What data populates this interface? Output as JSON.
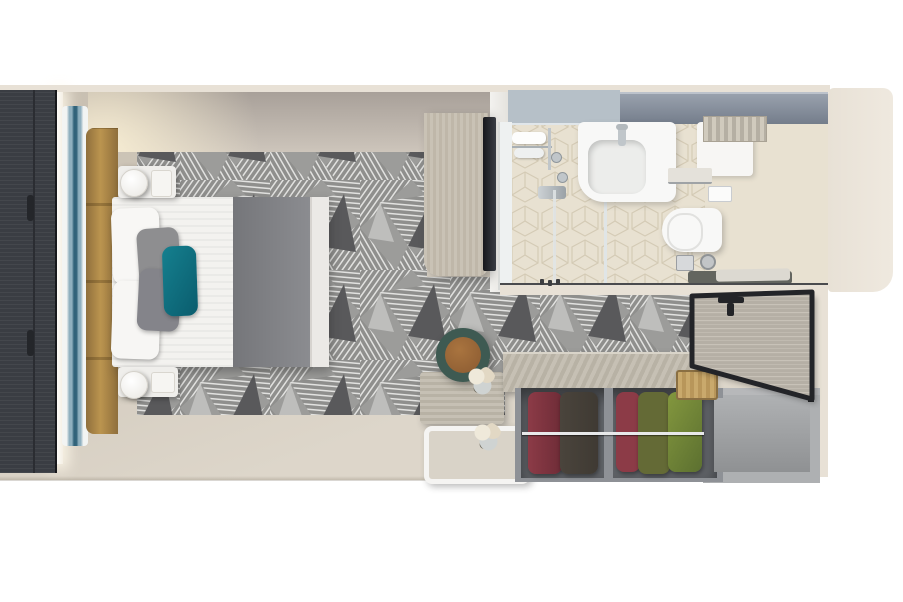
{
  "meta": {
    "title": "Top-down 3D rendered floor plan of a cruise-ship balcony stateroom",
    "canvas": {
      "width": 903,
      "height": 602
    }
  },
  "colors": {
    "wall-cream": "#e8e1d6",
    "floor-light": "#ddd6ca",
    "floor-dark": "#c7beb0",
    "panel-dark": "#3a3d43",
    "art-white": "#f2f4f3",
    "art-blue-mid": "#8fb0bf",
    "art-blue-deep": "#31637a",
    "headboard-tan-1": "#8f6f3c",
    "headboard-tan-2": "#bb944f",
    "wall-strip-1": "#a8a099",
    "wall-strip-2": "#cdc5bb",
    "carpet-base": "#9c9c9a",
    "carpet-mid": "#8f8f8d",
    "carpet-line": "#e2e2e0",
    "carpet-dark": "#59595b",
    "carpet-light": "#c4c4c2",
    "bed-white": "#f3f2ef",
    "runner-1": "#75767a",
    "runner-2": "#8b8c90",
    "pillow-gray": "#8e8e90",
    "pillow-teal-1": "#15808f",
    "pillow-teal-2": "#0a5c6d",
    "wood-light-1": "#c9c2b5",
    "wood-light-2": "#bfb7a9",
    "mirror-dark": "#17181c",
    "bath-floor": "#e8e1d1",
    "tile-line": "#d2c8b2",
    "cabinet-blue": "#b6c0c8",
    "mirror-blue-1": "#99a1ad",
    "mirror-blue-2": "#747d8b",
    "porcelain": "#f8f8f7",
    "chrome": "#c0c6ca",
    "glass-line": "#e0e5e6",
    "mat-dark": "#63655f",
    "mat-towel": "#dcd9d1",
    "stool-rim": "#3e5a52",
    "stool-leather": "#a9743f",
    "counter-wood-1": "#c6c0b4",
    "counter-wood-2": "#b8b2a5",
    "wardrobe-interior": "#5f6267",
    "wardrobe-frame": "#8e9196",
    "cloth-maroon": "#8c3b47",
    "cloth-dark": "#3f3a33",
    "cloth-olive": "#646a36",
    "cloth-green": "#83973e",
    "door-wood-1": "#b5afa5",
    "door-wood-2": "#c8c2b8",
    "frame-dark": "#232428",
    "nook-1": "#aeb0b2",
    "nook-2": "#8f9193"
  },
  "objects": {
    "bed": "double bed, white linens, grey foot runner, grey and teal pillows",
    "nightstands": "two white marble nightstands with cylindrical lamps",
    "headboard": "tan upholstered headboard panel",
    "artwork": "backlit blue marble art strip",
    "wardrobe-left": "full-height dark wood wardrobe wall",
    "carpet": "grey geometric patterned carpet",
    "desk": "light wood vanity desk with full-height mirror",
    "bathroom": "bathroom with shower, washbasin, toilet and mirrored cabinet",
    "stool": "round stool, teal rim with leather seat",
    "tables": "wood sideboard and white tray table with flowers",
    "closet": "open closet with hanging maroon, dark and green garments",
    "door": "cabin entrance door shown open",
    "nook": "luggage storage nook"
  }
}
